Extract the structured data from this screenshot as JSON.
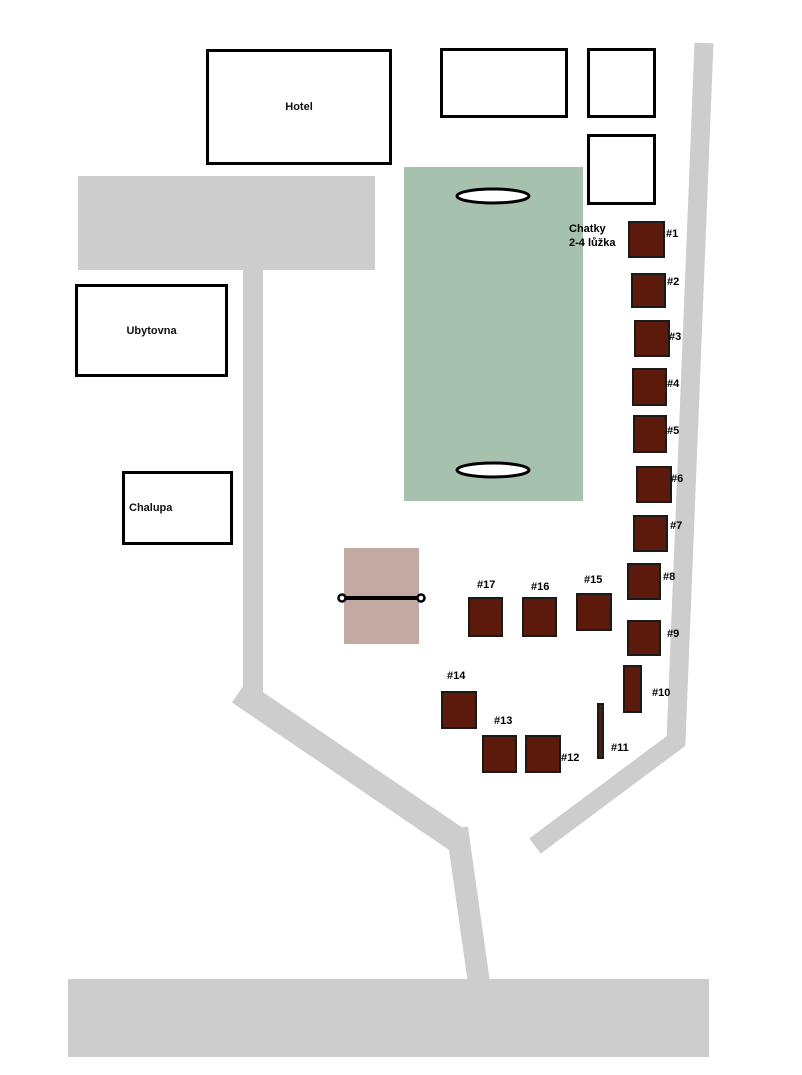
{
  "map": {
    "title": "Resort site plan",
    "colors": {
      "road": "#cdcdcd",
      "building-fill": "#ffffff",
      "building-border": "#000000",
      "cabin-fill": "#5b1a0b",
      "cabin-border": "#1a1a1a",
      "field": "#a6c2af",
      "court": "#c2aaa3"
    },
    "note": {
      "line1": "Chatky",
      "line2": "2-4 lůžka"
    },
    "buildings": [
      {
        "id": "hotel",
        "label": "Hotel",
        "x": 206,
        "y": 49,
        "w": 186,
        "h": 116,
        "label_align": "center"
      },
      {
        "id": "ubytovna",
        "label": "Ubytovna",
        "x": 75,
        "y": 284,
        "w": 153,
        "h": 93,
        "label_align": "center"
      },
      {
        "id": "chalupa",
        "label": "Chalupa",
        "x": 122,
        "y": 471,
        "w": 111,
        "h": 74,
        "label_align": "left"
      },
      {
        "id": "building-a",
        "label": "",
        "x": 440,
        "y": 48,
        "w": 128,
        "h": 70,
        "label_align": "center"
      },
      {
        "id": "building-b",
        "label": "",
        "x": 587,
        "y": 48,
        "w": 69,
        "h": 70,
        "label_align": "center"
      },
      {
        "id": "building-c",
        "label": "",
        "x": 587,
        "y": 134,
        "w": 69,
        "h": 71,
        "label_align": "center"
      }
    ],
    "cabins": [
      {
        "label": "#1",
        "x": 628,
        "y": 221,
        "w": 37,
        "h": 37,
        "lx": 666,
        "ly": 229
      },
      {
        "label": "#2",
        "x": 631,
        "y": 273,
        "w": 35,
        "h": 35,
        "lx": 667,
        "ly": 277
      },
      {
        "label": "#3",
        "x": 634,
        "y": 320,
        "w": 36,
        "h": 37,
        "lx": 669,
        "ly": 332
      },
      {
        "label": "#4",
        "x": 632,
        "y": 368,
        "w": 35,
        "h": 38,
        "lx": 667,
        "ly": 379
      },
      {
        "label": "#5",
        "x": 633,
        "y": 415,
        "w": 34,
        "h": 38,
        "lx": 667,
        "ly": 426
      },
      {
        "label": "#6",
        "x": 636,
        "y": 466,
        "w": 36,
        "h": 37,
        "lx": 671,
        "ly": 474
      },
      {
        "label": "#7",
        "x": 633,
        "y": 515,
        "w": 35,
        "h": 37,
        "lx": 670,
        "ly": 521
      },
      {
        "label": "#8",
        "x": 627,
        "y": 563,
        "w": 34,
        "h": 37,
        "lx": 663,
        "ly": 572
      },
      {
        "label": "#9",
        "x": 627,
        "y": 620,
        "w": 34,
        "h": 36,
        "lx": 667,
        "ly": 629
      },
      {
        "label": "#10",
        "x": 623,
        "y": 665,
        "w": 19,
        "h": 48,
        "lx": 652,
        "ly": 688
      },
      {
        "label": "#11",
        "x": 597,
        "y": 703,
        "w": 7,
        "h": 56,
        "lx": 611,
        "ly": 743
      },
      {
        "label": "#12",
        "x": 525,
        "y": 735,
        "w": 36,
        "h": 38,
        "lx": 561,
        "ly": 753
      },
      {
        "label": "#13",
        "x": 482,
        "y": 735,
        "w": 35,
        "h": 38,
        "lx": 494,
        "ly": 716
      },
      {
        "label": "#14",
        "x": 441,
        "y": 691,
        "w": 36,
        "h": 38,
        "lx": 447,
        "ly": 671
      },
      {
        "label": "#15",
        "x": 576,
        "y": 593,
        "w": 36,
        "h": 38,
        "lx": 584,
        "ly": 575
      },
      {
        "label": "#16",
        "x": 522,
        "y": 597,
        "w": 35,
        "h": 40,
        "lx": 531,
        "ly": 582
      },
      {
        "label": "#17",
        "x": 468,
        "y": 597,
        "w": 35,
        "h": 40,
        "lx": 477,
        "ly": 580
      }
    ]
  }
}
